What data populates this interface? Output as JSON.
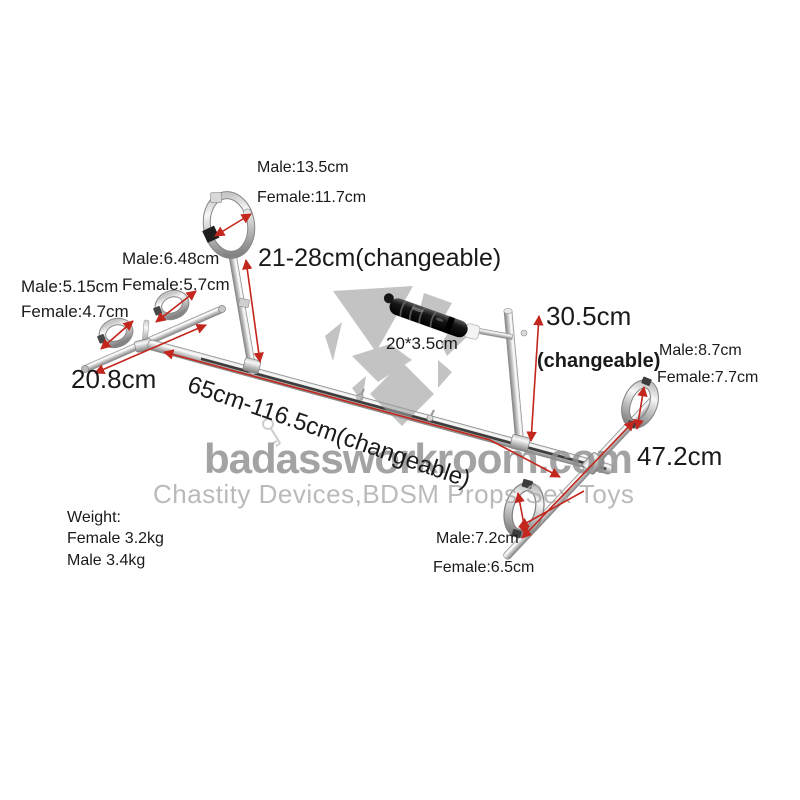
{
  "colors": {
    "arrow_red": "#c3261d",
    "watermark_gray": "#8f8f8f",
    "text": "#1a1a1a",
    "background": "#ffffff"
  },
  "watermark": {
    "site": "badassworkroom.com",
    "tagline": "Chastity Devices,BDSM Props Sex Toys"
  },
  "annotations": {
    "collar": {
      "male": "Male:13.5cm",
      "female": "Female:11.7cm"
    },
    "neck_post_height": "21-28cm(changeable)",
    "wrist_cuff_outer": {
      "male": "Male:6.48cm",
      "female": "Female:5.7cm"
    },
    "wrist_cuff_inner": {
      "male": "Male:5.15cm",
      "female": "Female:4.7cm"
    },
    "wrist_crossbar_length": "20.8cm",
    "main_bar_length": "65cm-116.5cm(changeable)",
    "dildo_size": "20*3.5cm",
    "rear_post_height": "30.5cm",
    "rear_post_note": "(changeable)",
    "ankle_cuff_upper": {
      "male": "Male:8.7cm",
      "female": "Female:7.7cm"
    },
    "ankle_bar_length": "47.2cm",
    "ankle_cuff_lower": {
      "male": "Male:7.2cm",
      "female": "Female:6.5cm"
    },
    "weight": {
      "title": "Weight:",
      "female": "Female 3.2kg",
      "male": "Male 3.4kg"
    }
  }
}
